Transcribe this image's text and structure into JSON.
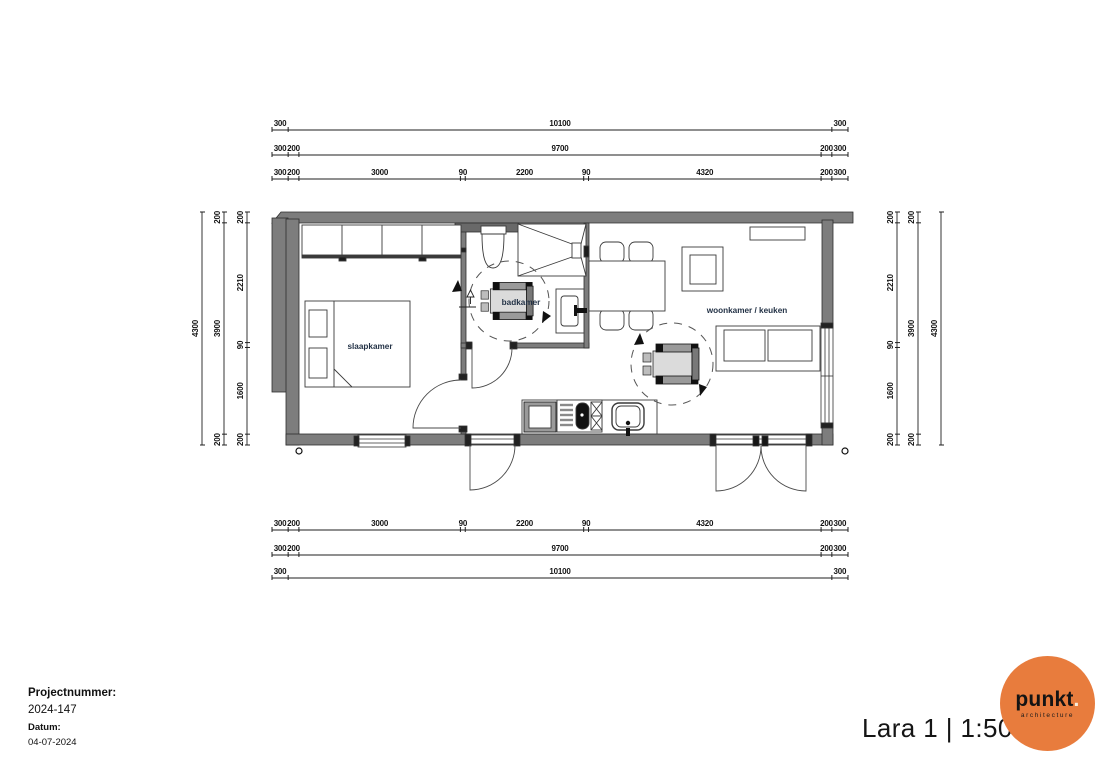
{
  "sheet": {
    "project": {
      "number_label": "Projectnummer:",
      "number": "2024-147",
      "date_label": "Datum:",
      "date": "04-07-2024"
    },
    "title": {
      "display": "Lara 1 | 1:50",
      "model": "Lara 1",
      "scale": "1:50"
    },
    "logo": {
      "brand": "punkt",
      "dot": ".",
      "tagline": "architecture"
    }
  },
  "rooms": {
    "bedroom": "slaapkamer",
    "bathroom": "badkamer",
    "living": "woonkamer / keuken"
  },
  "colors": {
    "wall_gray": "#7D7D7D",
    "accent_orange": "#E87C3D",
    "room_label": "#233246",
    "dim_text": "#141414"
  },
  "dimensions": {
    "horizontal": {
      "x_start": 272,
      "x_end": 848,
      "total_mm": 10700,
      "rows": [
        {
          "id": "top-overall",
          "line_y": 130,
          "segments": [
            300,
            10100,
            300
          ]
        },
        {
          "id": "top-shell",
          "line_y": 155,
          "segments": [
            300,
            200,
            9700,
            200,
            300
          ]
        },
        {
          "id": "top-detail",
          "line_y": 179,
          "segments": [
            300,
            200,
            3000,
            90,
            2200,
            90,
            4320,
            200,
            300
          ]
        },
        {
          "id": "bottom-detail",
          "line_y": 530,
          "segments": [
            300,
            200,
            3000,
            90,
            2200,
            90,
            4320,
            200,
            300
          ]
        },
        {
          "id": "bottom-shell",
          "line_y": 555,
          "segments": [
            300,
            200,
            9700,
            200,
            300
          ]
        },
        {
          "id": "bottom-overall",
          "line_y": 578,
          "segments": [
            300,
            10100,
            300
          ]
        }
      ]
    },
    "vertical": {
      "y_start": 212,
      "y_end": 445,
      "total_mm": 4300,
      "cols": [
        {
          "id": "left-overall",
          "line_x": 202,
          "segments": [
            4300
          ]
        },
        {
          "id": "left-shell",
          "line_x": 224,
          "segments": [
            200,
            3900,
            200
          ]
        },
        {
          "id": "left-detail",
          "line_x": 247,
          "segments": [
            200,
            2210,
            90,
            1600,
            200
          ]
        },
        {
          "id": "right-detail",
          "line_x": 897,
          "segments": [
            200,
            2210,
            90,
            1600,
            200
          ]
        },
        {
          "id": "right-shell",
          "line_x": 918,
          "segments": [
            200,
            3900,
            200
          ]
        },
        {
          "id": "right-overall",
          "line_x": 941,
          "segments": [
            4300
          ]
        }
      ]
    }
  }
}
